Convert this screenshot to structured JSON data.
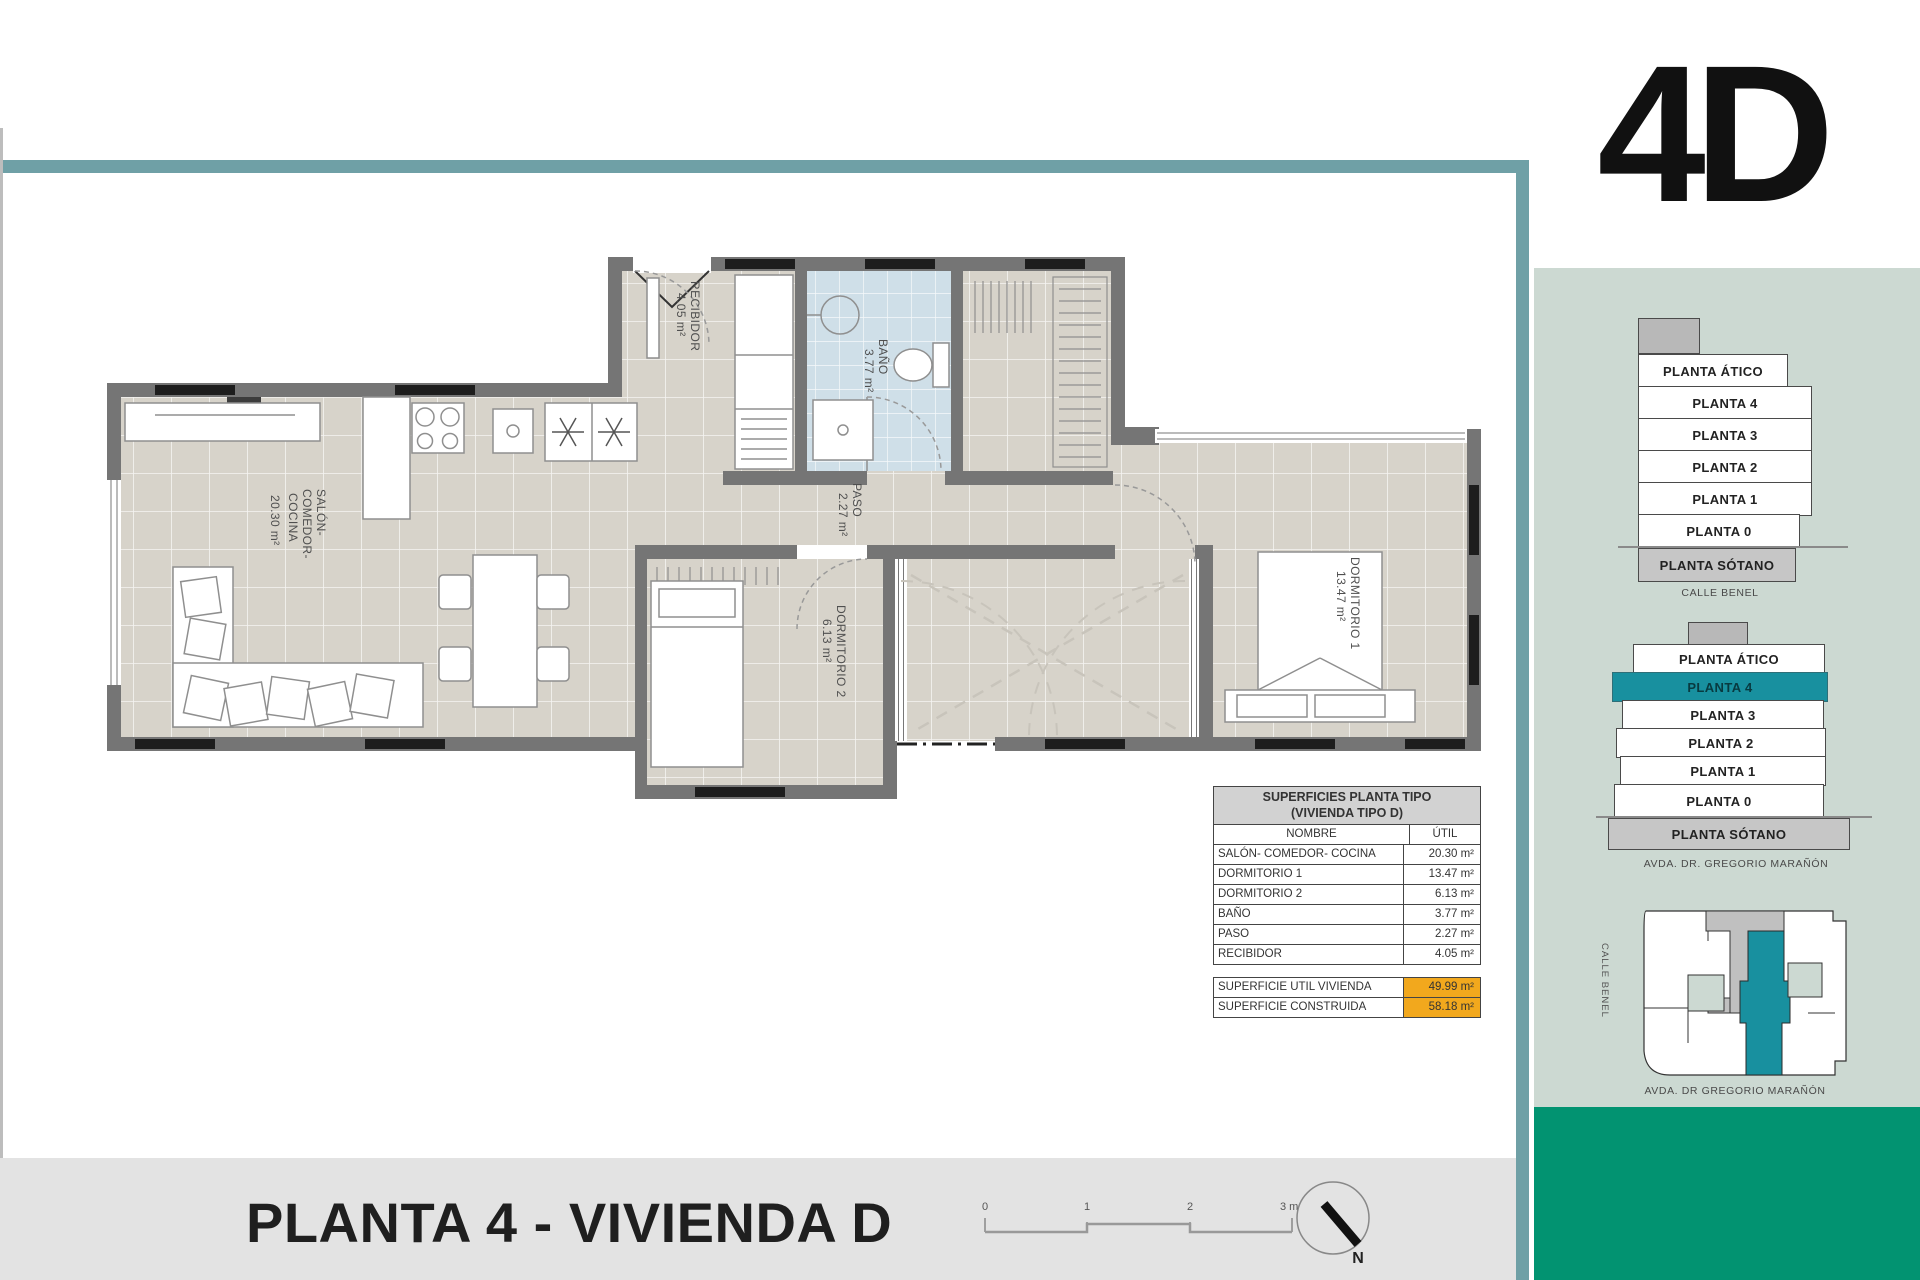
{
  "page": {
    "unit_code": "4D",
    "title": "PLANTA 4 - VIVIENDA D"
  },
  "plan": {
    "rooms": {
      "salon": {
        "line1": "SALÓN-",
        "line2": "COMEDOR-",
        "line3": "COCINA",
        "area": "20.30 m²"
      },
      "recibidor": {
        "name": "RECIBIDOR",
        "area": "4.05 m²"
      },
      "bano": {
        "name": "BAÑO",
        "area": "3.77 m²"
      },
      "paso": {
        "name": "PASO",
        "area": "2.27 m²"
      },
      "dormitorio1": {
        "name": "DORMITORIO 1",
        "area": "13.47 m²"
      },
      "dormitorio2": {
        "name": "DORMITORIO 2",
        "area": "6.13 m²"
      }
    }
  },
  "areas_table": {
    "title_line1": "SUPERFICIES PLANTA TIPO",
    "title_line2": "(VIVIENDA TIPO D)",
    "col_name": "NOMBRE",
    "col_util": "ÚTIL",
    "rows": [
      {
        "name": "SALÓN- COMEDOR- COCINA",
        "util": "20.30 m²"
      },
      {
        "name": "DORMITORIO 1",
        "util": "13.47 m²"
      },
      {
        "name": "DORMITORIO 2",
        "util": "6.13 m²"
      },
      {
        "name": "BAÑO",
        "util": "3.77 m²"
      },
      {
        "name": "PASO",
        "util": "2.27 m²"
      },
      {
        "name": "RECIBIDOR",
        "util": "4.05 m²"
      }
    ],
    "totals": [
      {
        "name": "SUPERFICIE UTIL VIVIENDA",
        "value": "49.99 m²"
      },
      {
        "name": "SUPERFICIE CONSTRUIDA",
        "value": "58.18 m²"
      }
    ]
  },
  "sidebar": {
    "stack_side": {
      "floors": [
        "PLANTA ÁTICO",
        "PLANTA 4",
        "PLANTA 3",
        "PLANTA 2",
        "PLANTA 1",
        "PLANTA 0",
        "PLANTA SÓTANO"
      ],
      "caption": "CALLE BENEL"
    },
    "stack_front": {
      "floors": [
        "PLANTA ÁTICO",
        "PLANTA 4",
        "PLANTA 3",
        "PLANTA 2",
        "PLANTA 1",
        "PLANTA 0",
        "PLANTA SÓTANO"
      ],
      "highlighted": "PLANTA 4",
      "caption": "AVDA. DR. GREGORIO MARAÑÓN"
    },
    "site_plan": {
      "street_left": "CALLE BENEL",
      "street_bottom": "AVDA. DR GREGORIO MARAÑÓN"
    }
  },
  "scale_bar": {
    "t0": "0",
    "t1": "1",
    "t2": "2",
    "t3": "3 m"
  },
  "compass": {
    "label": "N"
  },
  "colors": {
    "accent_teal": "#6fa0a6",
    "panel_green": "#ccd9d2",
    "dark_green": "#029371",
    "floor_highlight_teal": "#18909f",
    "highlight_orange": "#f2a81d"
  }
}
